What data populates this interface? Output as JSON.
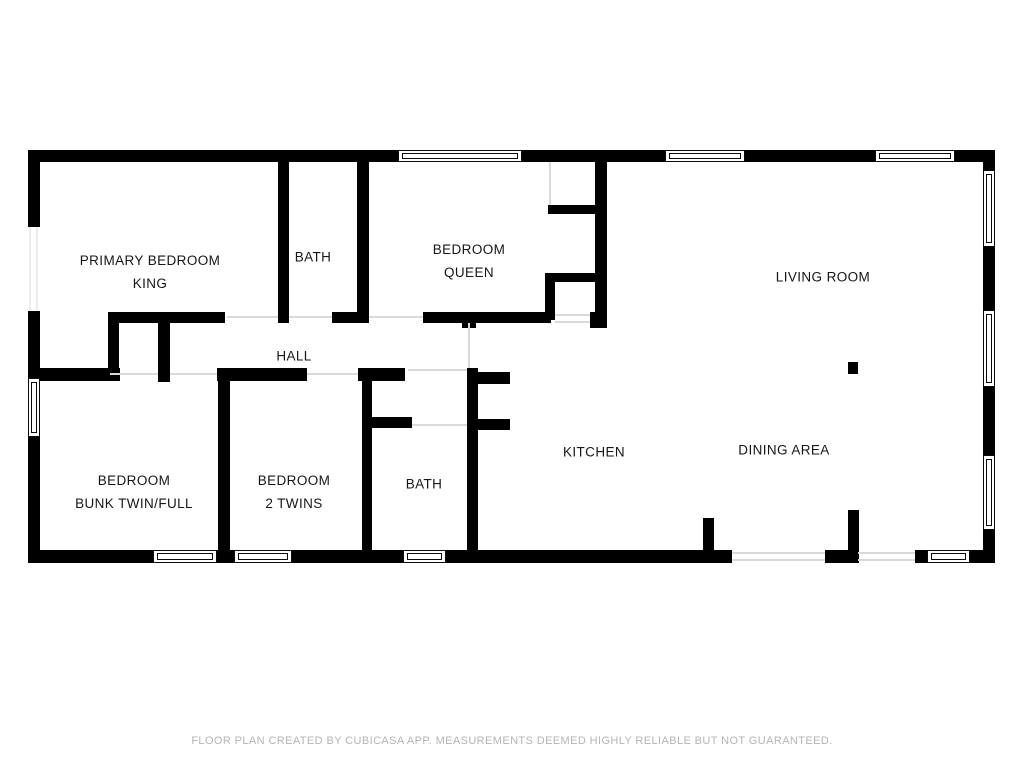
{
  "colors": {
    "background": "#ffffff",
    "wall": "#000000",
    "window_frame": "#0b0b0b",
    "door_line": "#d9d9d9",
    "door_line_faint": "#ececec",
    "label_text": "#161616",
    "footer_text": "#b4b4b4"
  },
  "rooms": [
    {
      "id": "primary-bedroom",
      "lines": [
        "PRIMARY BEDROOM",
        "KING"
      ],
      "cx": 150,
      "cy": 272
    },
    {
      "id": "bath-top",
      "lines": [
        "BATH"
      ],
      "cx": 313,
      "cy": 257
    },
    {
      "id": "bedroom-queen",
      "lines": [
        "BEDROOM",
        "QUEEN"
      ],
      "cx": 469,
      "cy": 261
    },
    {
      "id": "living-room",
      "lines": [
        "LIVING ROOM"
      ],
      "cx": 823,
      "cy": 277
    },
    {
      "id": "hall",
      "lines": [
        "HALL"
      ],
      "cx": 294,
      "cy": 356
    },
    {
      "id": "bedroom-bunk",
      "lines": [
        "BEDROOM",
        "BUNK TWIN/FULL"
      ],
      "cx": 134,
      "cy": 492
    },
    {
      "id": "bedroom-2-twins",
      "lines": [
        "BEDROOM",
        "2 TWINS"
      ],
      "cx": 294,
      "cy": 492
    },
    {
      "id": "bath-bottom",
      "lines": [
        "BATH"
      ],
      "cx": 424,
      "cy": 484
    },
    {
      "id": "kitchen",
      "lines": [
        "KITCHEN"
      ],
      "cx": 594,
      "cy": 452
    },
    {
      "id": "dining-area",
      "lines": [
        "DINING AREA"
      ],
      "cx": 784,
      "cy": 450
    }
  ],
  "plan": {
    "canvas": {
      "width": 1024,
      "height": 768
    },
    "walls": [
      [
        28,
        150,
        370,
        12
      ],
      [
        522,
        150,
        143,
        12
      ],
      [
        745,
        150,
        130,
        12
      ],
      [
        955,
        150,
        40,
        12
      ],
      [
        28,
        150,
        12,
        77
      ],
      [
        28,
        311,
        12,
        67
      ],
      [
        28,
        437,
        12,
        126
      ],
      [
        28,
        550,
        125,
        13
      ],
      [
        217,
        550,
        17,
        13
      ],
      [
        292,
        550,
        111,
        13
      ],
      [
        446,
        550,
        286,
        13
      ],
      [
        825,
        550,
        33,
        13
      ],
      [
        915,
        550,
        12,
        13
      ],
      [
        970,
        550,
        25,
        13
      ],
      [
        983,
        150,
        12,
        20
      ],
      [
        983,
        247,
        12,
        63
      ],
      [
        983,
        387,
        12,
        68
      ],
      [
        983,
        530,
        12,
        33
      ],
      [
        278,
        162,
        11,
        161
      ],
      [
        357,
        162,
        12,
        161
      ],
      [
        332,
        312,
        25,
        11
      ],
      [
        108,
        312,
        117,
        11
      ],
      [
        423,
        312,
        128,
        11
      ],
      [
        462,
        312,
        14,
        16
      ],
      [
        590,
        312,
        17,
        16
      ],
      [
        595,
        162,
        12,
        158
      ],
      [
        548,
        205,
        47,
        9
      ],
      [
        545,
        273,
        50,
        9
      ],
      [
        545,
        273,
        10,
        47
      ],
      [
        28,
        368,
        92,
        13
      ],
      [
        108,
        312,
        11,
        69
      ],
      [
        158,
        312,
        12,
        70
      ],
      [
        217,
        368,
        90,
        13
      ],
      [
        358,
        368,
        47,
        13
      ],
      [
        218,
        368,
        12,
        195
      ],
      [
        362,
        368,
        10,
        195
      ],
      [
        467,
        368,
        11,
        195
      ],
      [
        467,
        372,
        43,
        12
      ],
      [
        467,
        419,
        43,
        11
      ],
      [
        362,
        417,
        50,
        11
      ],
      [
        703,
        518,
        11,
        45
      ],
      [
        848,
        510,
        11,
        53
      ],
      [
        848,
        362,
        10,
        12
      ]
    ],
    "windows": [
      {
        "x": 398,
        "y": 150,
        "w": 124,
        "h": 12,
        "o": "h"
      },
      {
        "x": 665,
        "y": 150,
        "w": 80,
        "h": 12,
        "o": "h"
      },
      {
        "x": 875,
        "y": 150,
        "w": 80,
        "h": 12,
        "o": "h"
      },
      {
        "x": 153,
        "y": 550,
        "w": 64,
        "h": 13,
        "o": "h"
      },
      {
        "x": 234,
        "y": 550,
        "w": 58,
        "h": 13,
        "o": "h"
      },
      {
        "x": 403,
        "y": 550,
        "w": 43,
        "h": 13,
        "o": "h"
      },
      {
        "x": 927,
        "y": 550,
        "w": 43,
        "h": 13,
        "o": "h"
      },
      {
        "x": 983,
        "y": 170,
        "w": 12,
        "h": 77,
        "o": "v"
      },
      {
        "x": 983,
        "y": 310,
        "w": 12,
        "h": 77,
        "o": "v"
      },
      {
        "x": 983,
        "y": 455,
        "w": 12,
        "h": 75,
        "o": "v"
      },
      {
        "x": 28,
        "y": 378,
        "w": 12,
        "h": 59,
        "o": "v"
      }
    ],
    "door_lines": [
      {
        "x": 227,
        "y": 316,
        "w": 51,
        "h": 2
      },
      {
        "x": 289,
        "y": 316,
        "w": 43,
        "h": 2
      },
      {
        "x": 369,
        "y": 316,
        "w": 54,
        "h": 2
      },
      {
        "x": 110,
        "y": 373,
        "w": 48,
        "h": 2
      },
      {
        "x": 170,
        "y": 373,
        "w": 47,
        "h": 2
      },
      {
        "x": 307,
        "y": 373,
        "w": 51,
        "h": 2
      },
      {
        "x": 408,
        "y": 369,
        "w": 59,
        "h": 2
      },
      {
        "x": 412,
        "y": 424,
        "w": 55,
        "h": 2
      },
      {
        "x": 468,
        "y": 323,
        "w": 2,
        "h": 45
      },
      {
        "x": 549,
        "y": 162,
        "w": 2,
        "h": 43
      },
      {
        "x": 555,
        "y": 314,
        "w": 35,
        "h": 2
      },
      {
        "x": 555,
        "y": 321,
        "w": 35,
        "h": 2
      },
      {
        "x": 732,
        "y": 552,
        "w": 93,
        "h": 2
      },
      {
        "x": 858,
        "y": 552,
        "w": 57,
        "h": 2
      },
      {
        "x": 732,
        "y": 559,
        "w": 93,
        "h": 2
      },
      {
        "x": 858,
        "y": 559,
        "w": 57,
        "h": 2
      },
      {
        "x": 29,
        "y": 227,
        "w": 2,
        "h": 84,
        "faint": true
      },
      {
        "x": 36,
        "y": 227,
        "w": 2,
        "h": 84,
        "faint": true
      }
    ]
  },
  "footer": {
    "disclaimer": "FLOOR PLAN CREATED BY CUBICASA APP. MEASUREMENTS DEEMED HIGHLY RELIABLE BUT NOT GUARANTEED."
  }
}
